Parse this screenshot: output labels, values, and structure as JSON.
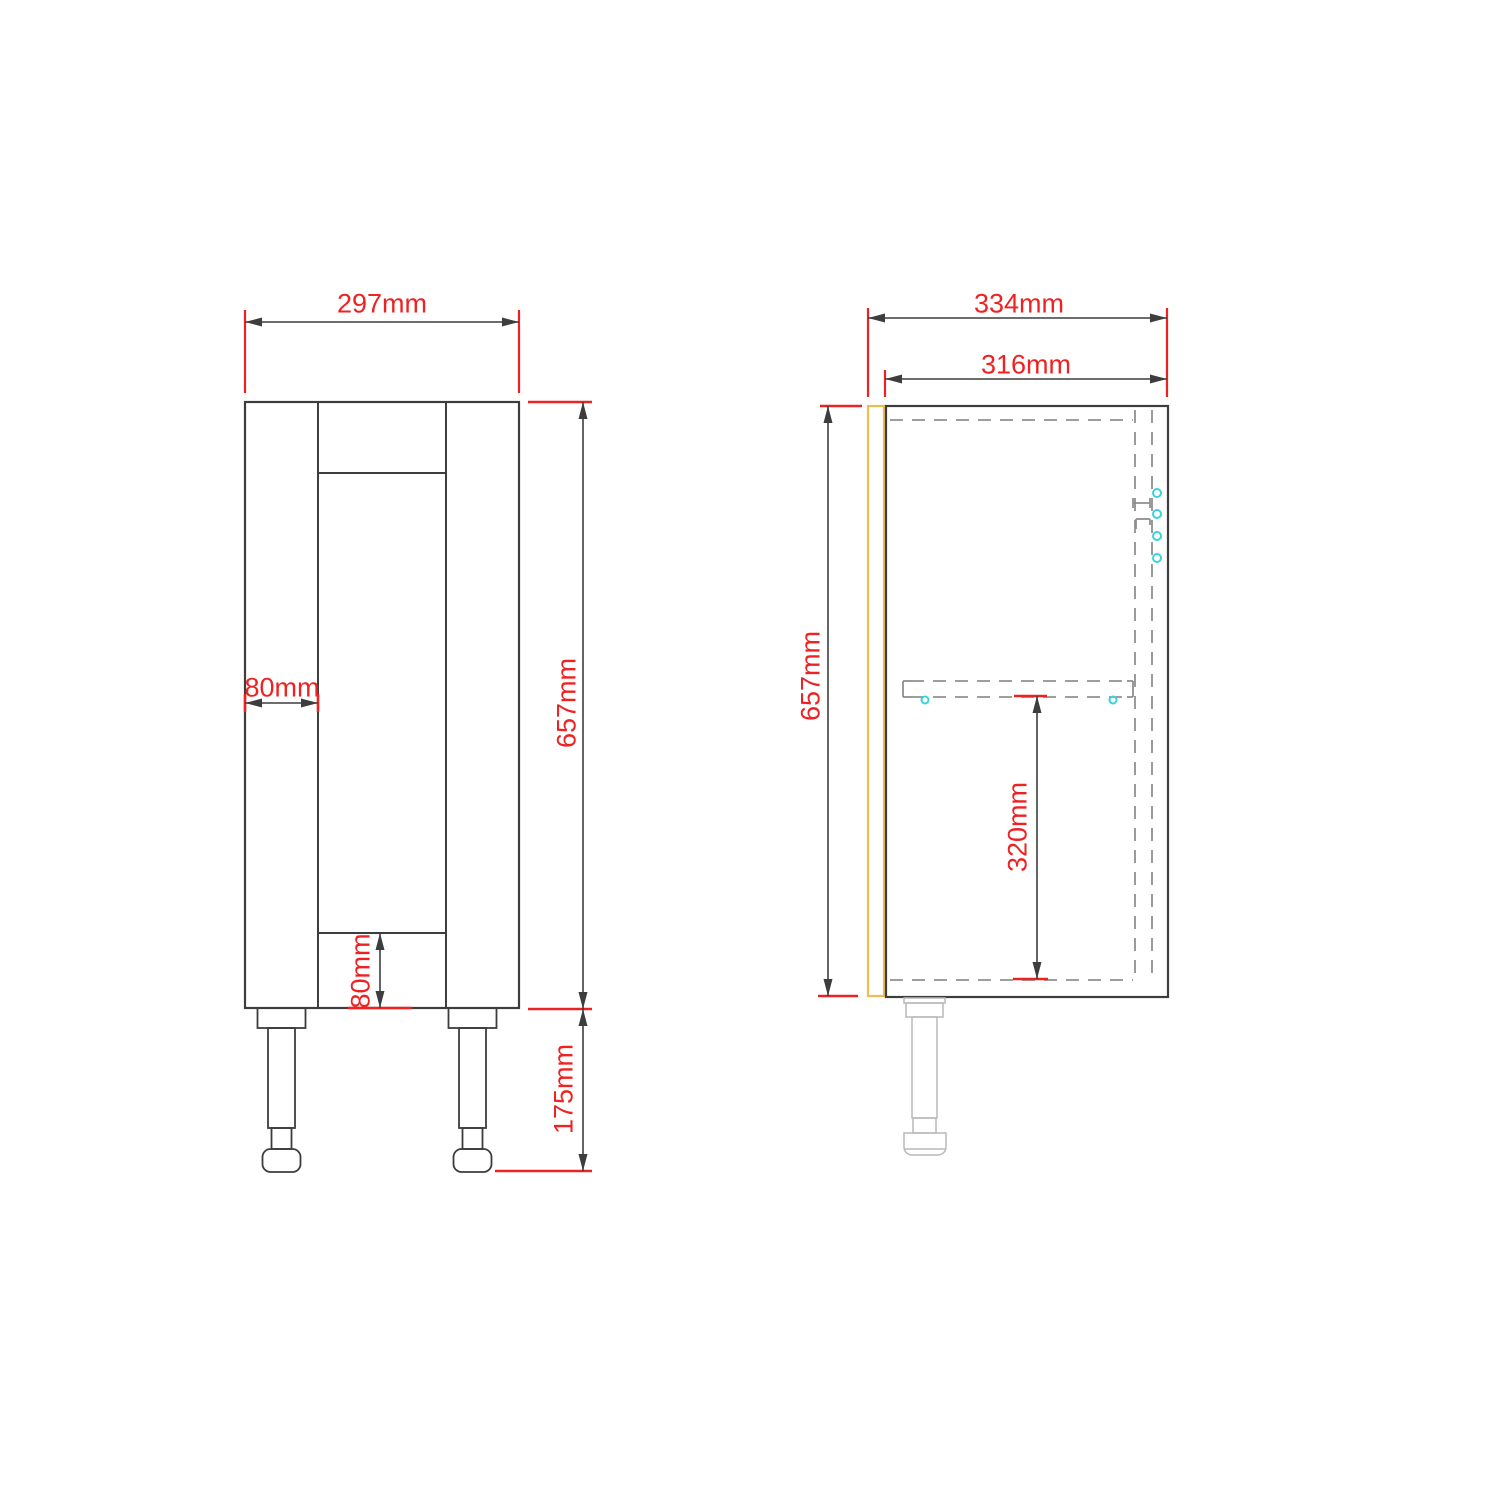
{
  "drawing": {
    "canvas": {
      "width": 1500,
      "height": 1500,
      "background": "#ffffff"
    },
    "colors": {
      "line": "#3d3d3d",
      "dashed": "#909090",
      "solid_gray": "#8f8f8f",
      "dim_red": "#ee2222",
      "door_yellow": "#edbe4e",
      "hardware_cyan": "#3ad2e0",
      "leg_gray": "#b9b9b9",
      "background": "#ffffff"
    },
    "stroke_widths": {
      "outline": 2.2,
      "inner": 2,
      "dashed": 1.8,
      "dim_line": 1.6,
      "tick": 2.6,
      "ext": 2.2,
      "hardware": 2
    },
    "dash_pattern": "13 9",
    "label_font_size": 27,
    "front_view": {
      "name": "front-view",
      "shapes": [
        {
          "kind": "rect",
          "name": "front-cabinet-outline",
          "x": 245,
          "y": 402,
          "w": 274,
          "h": 606,
          "style": "line",
          "sw": 2.2
        },
        {
          "kind": "line",
          "name": "front-left-stile-line",
          "x1": 318,
          "y1": 402,
          "x2": 318,
          "y2": 1008,
          "style": "line",
          "sw": 2
        },
        {
          "kind": "line",
          "name": "front-right-stile-line",
          "x1": 446,
          "y1": 402,
          "x2": 446,
          "y2": 1008,
          "style": "line",
          "sw": 2
        },
        {
          "kind": "line",
          "name": "front-top-rail-line",
          "x1": 318,
          "y1": 473,
          "x2": 446,
          "y2": 473,
          "style": "line",
          "sw": 2
        },
        {
          "kind": "line",
          "name": "front-bottom-rail-line",
          "x1": 318,
          "y1": 933,
          "x2": 446,
          "y2": 933,
          "style": "line",
          "sw": 2
        },
        {
          "kind": "rect",
          "name": "front-left-leg-plate",
          "x": 257.5,
          "y": 1008,
          "w": 48,
          "h": 20,
          "style": "line",
          "sw": 1.8
        },
        {
          "kind": "rect",
          "name": "front-left-leg-shaft",
          "x": 268,
          "y": 1028,
          "w": 27,
          "h": 100,
          "style": "line",
          "sw": 1.8
        },
        {
          "kind": "rect",
          "name": "front-left-leg-neck",
          "x": 271.5,
          "y": 1128,
          "w": 20,
          "h": 21,
          "style": "line",
          "sw": 1.8
        },
        {
          "kind": "rect",
          "name": "front-left-leg-foot",
          "x": 262.5,
          "y": 1149,
          "w": 38,
          "h": 23,
          "rx": 8,
          "style": "line",
          "sw": 1.8
        },
        {
          "kind": "rect",
          "name": "front-right-leg-plate",
          "x": 448.5,
          "y": 1008,
          "w": 48,
          "h": 20,
          "style": "line",
          "sw": 1.8
        },
        {
          "kind": "rect",
          "name": "front-right-leg-shaft",
          "x": 459,
          "y": 1028,
          "w": 27,
          "h": 100,
          "style": "line",
          "sw": 1.8
        },
        {
          "kind": "rect",
          "name": "front-right-leg-neck",
          "x": 462.5,
          "y": 1128,
          "w": 20,
          "h": 21,
          "style": "line",
          "sw": 1.8
        },
        {
          "kind": "rect",
          "name": "front-right-leg-foot",
          "x": 453.5,
          "y": 1149,
          "w": 38,
          "h": 23,
          "rx": 8,
          "style": "line",
          "sw": 1.8
        }
      ]
    },
    "side_view": {
      "name": "side-view",
      "shapes": [
        {
          "kind": "rect",
          "name": "side-door-panel",
          "x": 868,
          "y": 406,
          "w": 16,
          "h": 590,
          "style": "door_yellow",
          "sw": 2.2
        },
        {
          "kind": "rect",
          "name": "side-carcass-outline",
          "x": 886,
          "y": 406,
          "w": 282,
          "h": 591,
          "style": "line",
          "sw": 2.2
        },
        {
          "kind": "dline",
          "name": "side-top-panel-dashed",
          "x1": 890,
          "y1": 420,
          "x2": 1133,
          "y2": 420
        },
        {
          "kind": "dline",
          "name": "side-bottom-panel-dashed",
          "x1": 890,
          "y1": 980,
          "x2": 1133,
          "y2": 980
        },
        {
          "kind": "dline",
          "name": "side-back-panel-dashed-1",
          "x1": 1135,
          "y1": 410,
          "x2": 1135,
          "y2": 982
        },
        {
          "kind": "dline",
          "name": "side-back-panel-dashed-2",
          "x1": 1152,
          "y1": 410,
          "x2": 1152,
          "y2": 982
        },
        {
          "kind": "line",
          "name": "side-shelf-front-cap",
          "x1": 903,
          "y1": 681,
          "x2": 903,
          "y2": 697,
          "style": "solid_gray",
          "sw": 1.8
        },
        {
          "kind": "line",
          "name": "side-shelf-front-cap-top",
          "x1": 903,
          "y1": 681,
          "x2": 911,
          "y2": 681,
          "style": "solid_gray",
          "sw": 1.8
        },
        {
          "kind": "line",
          "name": "side-shelf-front-cap-bot",
          "x1": 903,
          "y1": 697,
          "x2": 911,
          "y2": 697,
          "style": "solid_gray",
          "sw": 1.8
        },
        {
          "kind": "dline",
          "name": "side-shelf-top-dashed",
          "x1": 911,
          "y1": 681,
          "x2": 1127,
          "y2": 681
        },
        {
          "kind": "dline",
          "name": "side-shelf-bottom-dashed",
          "x1": 911,
          "y1": 697,
          "x2": 1127,
          "y2": 697
        },
        {
          "kind": "line",
          "name": "side-shelf-back-cap",
          "x1": 1133,
          "y1": 681,
          "x2": 1133,
          "y2": 697,
          "style": "solid_gray",
          "sw": 1.8
        },
        {
          "kind": "line",
          "name": "side-shelf-back-cap-top",
          "x1": 1127,
          "y1": 681,
          "x2": 1133,
          "y2": 681,
          "style": "solid_gray",
          "sw": 1.8
        },
        {
          "kind": "line",
          "name": "side-shelf-back-cap-bot",
          "x1": 1127,
          "y1": 697,
          "x2": 1133,
          "y2": 697,
          "style": "solid_gray",
          "sw": 1.8
        },
        {
          "kind": "line",
          "name": "side-hinge-bar",
          "x1": 1133,
          "y1": 503,
          "x2": 1150,
          "y2": 503,
          "style": "solid_gray",
          "sw": 1.8
        },
        {
          "kind": "line",
          "name": "side-hinge-bar-cap-left",
          "x1": 1133,
          "y1": 498,
          "x2": 1133,
          "y2": 508,
          "style": "solid_gray",
          "sw": 1.8
        },
        {
          "kind": "line",
          "name": "side-hinge-bar-cap-right",
          "x1": 1150,
          "y1": 498,
          "x2": 1150,
          "y2": 508,
          "style": "solid_gray",
          "sw": 1.8
        },
        {
          "kind": "line",
          "name": "side-hinge-bracket-top",
          "x1": 1136,
          "y1": 519,
          "x2": 1150,
          "y2": 519,
          "style": "solid_gray",
          "sw": 1.8
        },
        {
          "kind": "line",
          "name": "side-hinge-bracket-left",
          "x1": 1136,
          "y1": 519,
          "x2": 1136,
          "y2": 529,
          "style": "solid_gray",
          "sw": 1.8
        },
        {
          "kind": "line",
          "name": "side-hinge-bracket-right",
          "x1": 1150,
          "y1": 519,
          "x2": 1150,
          "y2": 525,
          "style": "solid_gray",
          "sw": 1.8
        },
        {
          "kind": "circle",
          "name": "side-shelf-pin-front",
          "cx": 925,
          "cy": 700,
          "r": 3.5,
          "style": "hardware_cyan",
          "sw": 2
        },
        {
          "kind": "circle",
          "name": "side-shelf-pin-back",
          "cx": 1113,
          "cy": 700,
          "r": 3.5,
          "style": "hardware_cyan",
          "sw": 2
        },
        {
          "kind": "circle",
          "name": "side-hinge-screw-1",
          "cx": 1157,
          "cy": 493,
          "r": 4,
          "style": "hardware_cyan",
          "sw": 2
        },
        {
          "kind": "circle",
          "name": "side-hinge-screw-2",
          "cx": 1157,
          "cy": 514,
          "r": 4,
          "style": "hardware_cyan",
          "sw": 2
        },
        {
          "kind": "circle",
          "name": "side-hinge-screw-3",
          "cx": 1157,
          "cy": 536,
          "r": 4,
          "style": "hardware_cyan",
          "sw": 2
        },
        {
          "kind": "circle",
          "name": "side-hinge-screw-4",
          "cx": 1157,
          "cy": 558,
          "r": 4,
          "style": "hardware_cyan",
          "sw": 2
        },
        {
          "kind": "rect",
          "name": "side-leg-lip",
          "x": 904,
          "y": 998,
          "w": 41,
          "h": 5,
          "style": "leg_gray",
          "sw": 1.5
        },
        {
          "kind": "rect",
          "name": "side-leg-plate",
          "x": 906,
          "y": 1003,
          "w": 37,
          "h": 14,
          "style": "leg_gray",
          "sw": 1.5
        },
        {
          "kind": "rect",
          "name": "side-leg-shaft",
          "x": 912,
          "y": 1017,
          "w": 25,
          "h": 101,
          "style": "leg_gray",
          "sw": 1.5
        },
        {
          "kind": "rect",
          "name": "side-leg-neck",
          "x": 913,
          "y": 1118,
          "w": 23,
          "h": 15,
          "style": "leg_gray",
          "sw": 1.5
        },
        {
          "kind": "path",
          "name": "side-leg-foot",
          "d": "M904,1133 h42 v14 a8,8 0 0 1 -8,8 h-26 a8,8 0 0 1 -8,-8 z",
          "style": "leg_gray",
          "sw": 1.5
        },
        {
          "kind": "line",
          "name": "side-leg-foot-line",
          "x1": 904,
          "y1": 1149,
          "x2": 946,
          "y2": 1149,
          "style": "leg_gray",
          "sw": 1.5
        }
      ]
    },
    "dimensions": [
      {
        "name": "front-overall-width-dim",
        "label": "297mm",
        "ext": [
          [
            245,
            310,
            245,
            393
          ],
          [
            519,
            310,
            519,
            393
          ]
        ],
        "ticks": [],
        "line": [
          245,
          322,
          519,
          322
        ],
        "text": {
          "x": 382,
          "y": 303,
          "rot": 0
        }
      },
      {
        "name": "front-cabinet-height-dim",
        "label": "657mm",
        "ext": [],
        "ticks": [
          [
            528,
            402,
            592,
            402
          ],
          [
            528,
            1009,
            592,
            1009
          ]
        ],
        "line": [
          583,
          402,
          583,
          1009
        ],
        "text": {
          "x": 566,
          "y": 703,
          "rot": -90
        }
      },
      {
        "name": "front-leg-height-dim",
        "label": "175mm",
        "ext": [],
        "ticks": [
          [
            495,
            1171,
            592,
            1171
          ]
        ],
        "line": [
          583,
          1009,
          583,
          1171
        ],
        "text": {
          "x": 563,
          "y": 1089,
          "rot": -90
        }
      },
      {
        "name": "front-stile-width-dim",
        "label": "80mm",
        "ext": [],
        "ticks": [
          [
            245,
            694,
            245,
            712
          ],
          [
            318,
            694,
            318,
            712
          ]
        ],
        "line": [
          245,
          703,
          318,
          703
        ],
        "text": {
          "x": 282,
          "y": 687,
          "rot": 0
        }
      },
      {
        "name": "front-bottom-rail-dim",
        "label": "80mm",
        "ext": [],
        "ticks": [
          [
            348,
            1008,
            412,
            1008
          ]
        ],
        "line": [
          380,
          933,
          380,
          1008
        ],
        "text": {
          "x": 360,
          "y": 971,
          "rot": -90
        }
      },
      {
        "name": "side-overall-depth-dim",
        "label": "334mm",
        "ext": [
          [
            868,
            308,
            868,
            397
          ],
          [
            1167,
            308,
            1167,
            397
          ]
        ],
        "ticks": [],
        "line": [
          868,
          318,
          1167,
          318
        ],
        "text": {
          "x": 1019,
          "y": 303,
          "rot": 0
        }
      },
      {
        "name": "side-carcass-depth-dim",
        "label": "316mm",
        "ext": [
          [
            885,
            370,
            885,
            397
          ]
        ],
        "ticks": [],
        "line": [
          885,
          379,
          1167,
          379
        ],
        "text": {
          "x": 1026,
          "y": 364,
          "rot": 0
        }
      },
      {
        "name": "side-carcass-height-dim",
        "label": "657mm",
        "ext": [],
        "ticks": [
          [
            820,
            406,
            862,
            406
          ],
          [
            818,
            996,
            858,
            996
          ]
        ],
        "line": [
          828,
          406,
          828,
          996
        ],
        "text": {
          "x": 810,
          "y": 676,
          "rot": -90
        }
      },
      {
        "name": "side-shelf-height-dim",
        "label": "320mm",
        "ext": [],
        "ticks": [
          [
            1014,
            696,
            1047,
            696
          ],
          [
            1013,
            979,
            1048,
            979
          ]
        ],
        "line": [
          1037,
          696,
          1037,
          979
        ],
        "text": {
          "x": 1017,
          "y": 827,
          "rot": -90
        }
      }
    ]
  }
}
